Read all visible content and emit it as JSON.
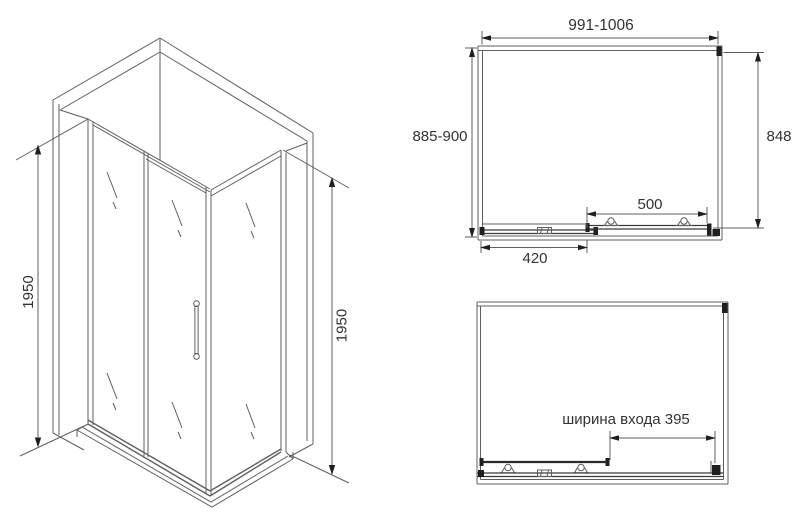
{
  "colors": {
    "background": "#ffffff",
    "line": "#5e5f61",
    "dark": "#1f1f21",
    "text": "#333333"
  },
  "isometric_view": {
    "height_left": "1950",
    "height_right": "1950"
  },
  "top_view": {
    "overall_width": "991-1006",
    "overall_depth": "885-900",
    "side_depth": "848",
    "door_panel_width": "500",
    "fixed_panel_width": "420"
  },
  "open_view": {
    "entrance_width": "ширина входа 395"
  }
}
